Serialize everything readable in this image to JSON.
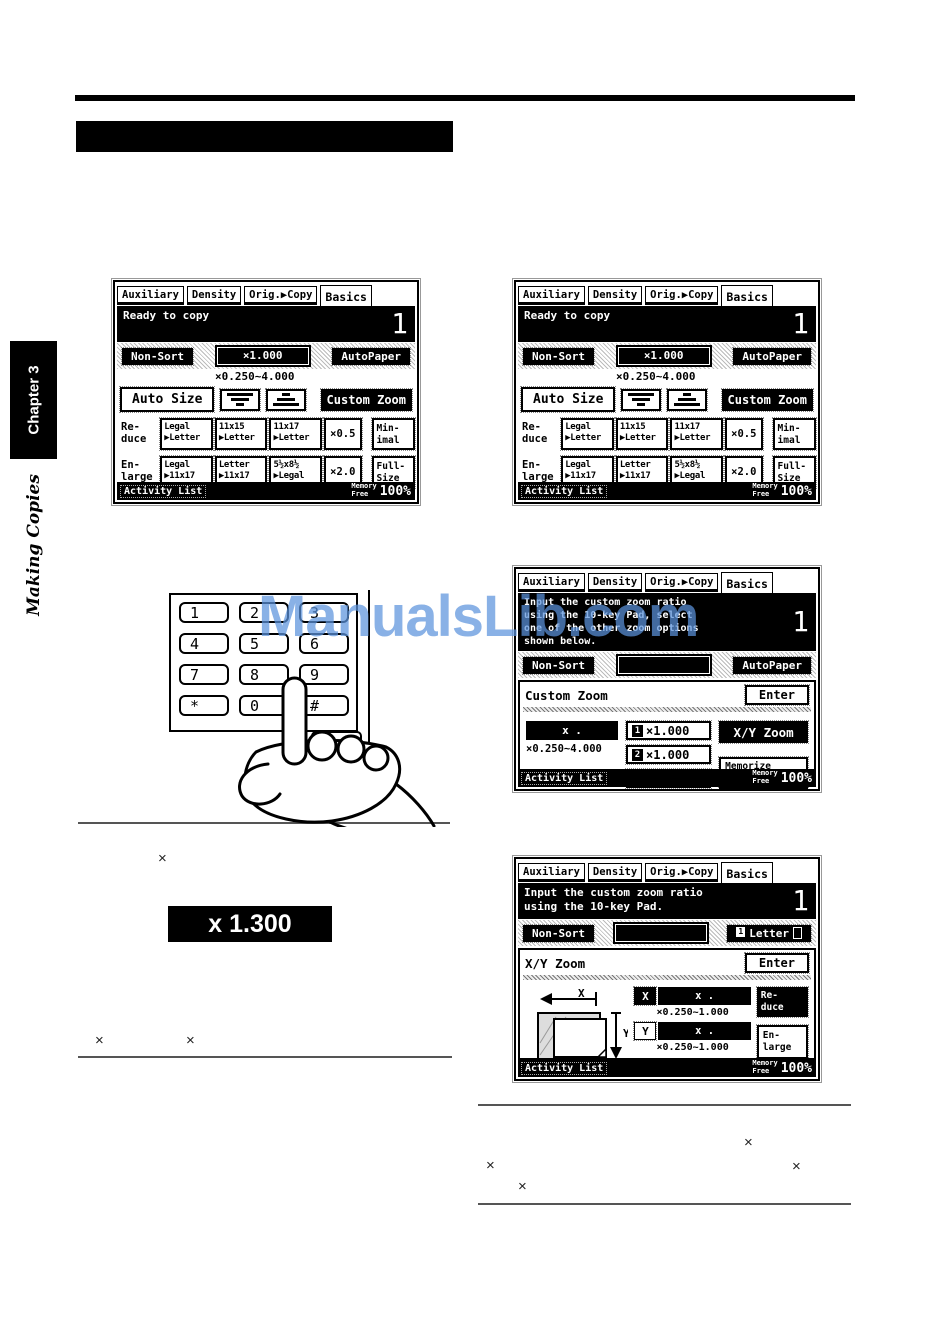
{
  "watermark": "ManualsLib.com",
  "sidebar": {
    "chapter": "Chapter 3",
    "section": "Making Copies"
  },
  "symbols": {
    "times": "×"
  },
  "ratio_display": {
    "value": "x 1.300"
  },
  "keypad": {
    "keys": [
      "1",
      "2",
      "3",
      "4",
      "5",
      "6",
      "7",
      "8",
      "9",
      "*",
      "0",
      "#"
    ]
  },
  "copier": {
    "tabs": [
      "Auxiliary",
      "Density",
      "Orig.▶Copy",
      "Basics"
    ],
    "count": "1",
    "non_sort": "Non-Sort",
    "auto_paper": "AutoPaper",
    "enter": "Enter",
    "activity_list": "Activity List",
    "memory": "Memory\nFree",
    "memory_value": "100%"
  },
  "screen_basics": {
    "message": "Ready to copy",
    "zoom_value": "×1.000",
    "zoom_range": "×0.250~4.000",
    "auto_size": "Auto Size",
    "custom_zoom": "Custom Zoom",
    "reduce_label": "Re-\nduce",
    "enlarge_label": "En-\nlarge",
    "reduce_buttons": [
      "Legal\n▶Letter",
      "11x15\n▶Letter",
      "11x17\n▶Letter",
      "×0.5",
      "Min-\nimal"
    ],
    "enlarge_buttons": [
      "Legal\n▶11x17",
      "Letter\n▶11x17",
      "5½x8½\n▶Legal",
      "×2.0",
      "Full-\nSize"
    ]
  },
  "screen_custom_zoom": {
    "message": "Input the custom zoom ratio\nusing the 10-key Pad, select\none of the other zoom options\nshown below.",
    "title": "Custom Zoom",
    "value_display": "x .",
    "range": "×0.250~4.000",
    "preset_1_num": "1",
    "preset_1_value": "×1.000",
    "preset_2_num": "2",
    "preset_2_value": "×1.000",
    "minimal": "Minimal",
    "xy_zoom": "X/Y Zoom",
    "memorize": "Memorize\nZoom Ratio"
  },
  "screen_xy_zoom": {
    "message": "Input the custom zoom ratio\nusing the 10-key Pad.",
    "tray_num": "1",
    "paper_size": "Letter",
    "title": "X/Y Zoom",
    "x_key": "X",
    "x_value": "x .",
    "x_range": "×0.250~1.000",
    "y_key": "Y",
    "y_value": "x .",
    "y_range": "×0.250~1.000",
    "reduce": "Re-\nduce",
    "enlarge": "En-\nlarge",
    "diagram_x": "X",
    "diagram_y": "Y"
  }
}
